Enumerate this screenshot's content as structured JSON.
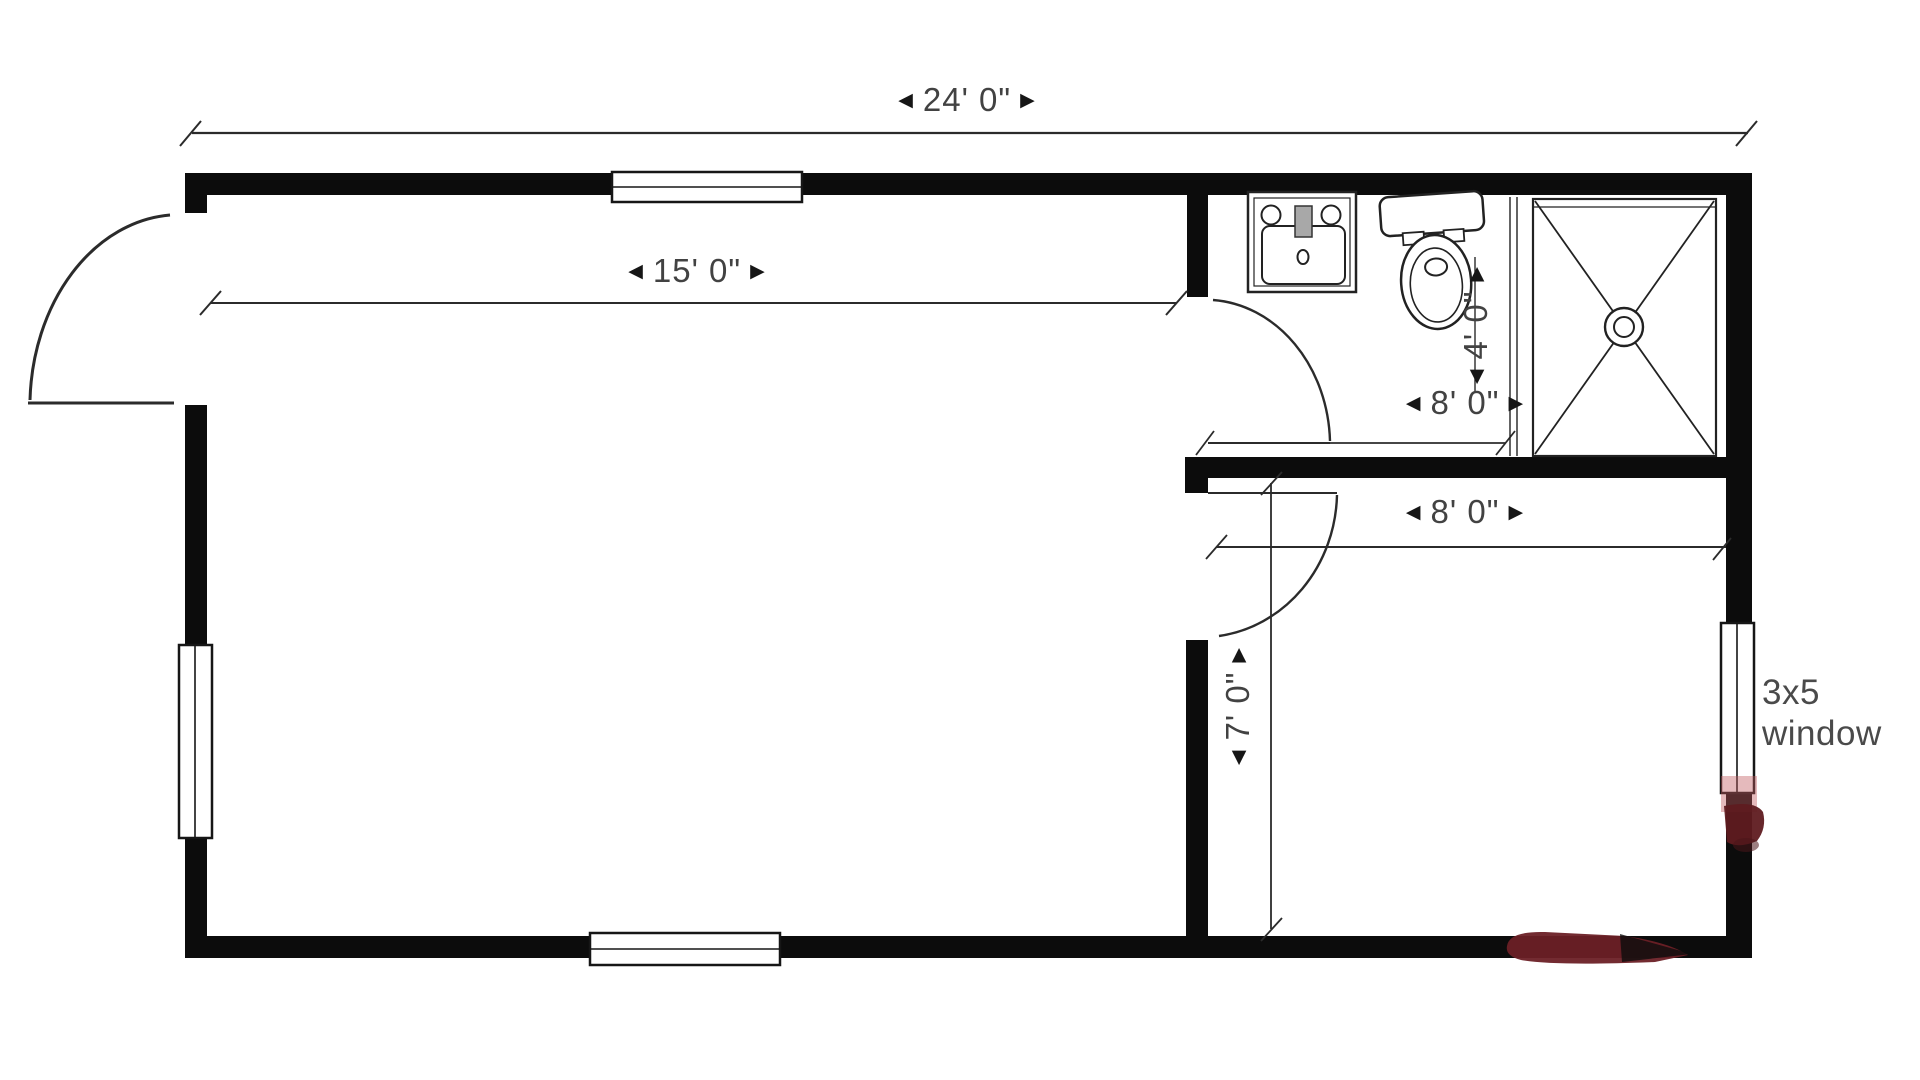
{
  "colors": {
    "wall": "#0c0c0c",
    "line": "#2b2b2b",
    "text": "#424242",
    "smudge_dark": "#6b2026",
    "smudge_light": "#c05a60"
  },
  "icons": {
    "arrow_left": "◀",
    "arrow_right": "▶"
  },
  "dimensions": {
    "overall_width": "24' 0\"",
    "living_room_width": "15' 0\"",
    "bathroom_width": "8' 0\"",
    "bathroom_depth": "4' 0\"",
    "bedroom_width": "8' 0\"",
    "bedroom_depth": "7' 0\""
  },
  "annotations": {
    "right_window_line1": "3x5",
    "right_window_line2": "window"
  }
}
